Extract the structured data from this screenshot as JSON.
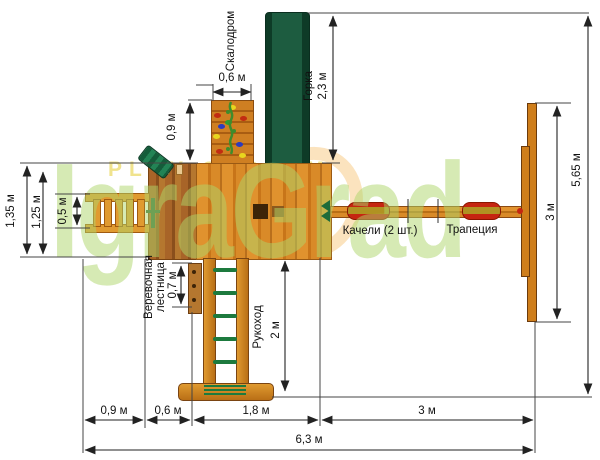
{
  "watermark": {
    "brand": "IgraGrad",
    "tagline": "PLAY SYSTEM"
  },
  "labels": {
    "climbing_wall": "Скалодром",
    "slide": "Горка",
    "rope_ladder_1": "Веревочная",
    "rope_ladder_2": "лестница",
    "monkey_bars": "Рукоход",
    "swings": "Качели (2 шт.)",
    "trapeze": "Трапеция"
  },
  "dims": {
    "wall_width": "0,6 м",
    "wall_offset": "0,9 м",
    "slide_length": "2,3 м",
    "total_height": "5,65 м",
    "swing_frame": "3 м",
    "left_total": "1,35 м",
    "left_inner": "1,25 м",
    "ladder": "0,5 м",
    "rope_ladder": "0,7 м",
    "monkey_bars": "2 м",
    "bottom_ladder": "0,9 м",
    "bottom_balcony": "0,6 м",
    "bottom_platform": "1,8 м",
    "bottom_swings": "3 м",
    "bottom_total": "6,3 м"
  },
  "colors": {
    "wood": "#d9882a",
    "wood_dark": "#8b4a12",
    "slide_green": "#1d5c40",
    "rung_green": "#1d7a3e",
    "swing_red": "#c52511",
    "dim_line": "#222222",
    "watermark_green": "#add669",
    "watermark_yellow": "#eee08c",
    "hold_yellow": "#e8d61e",
    "hold_red": "#c22c12",
    "hold_blue": "#2b3bbf",
    "hold_green": "#2f9e2f"
  }
}
